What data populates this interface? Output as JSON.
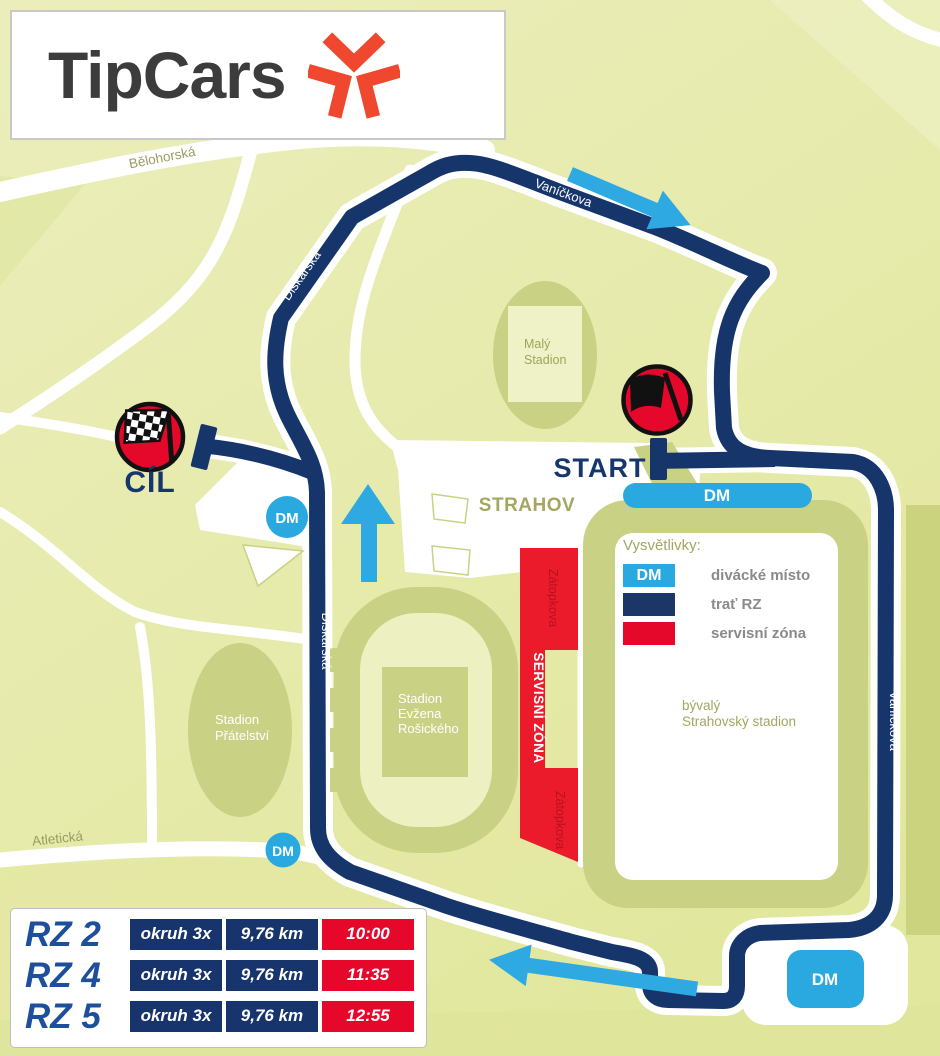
{
  "logo": {
    "brand": "TipCars"
  },
  "colors": {
    "navy": "#16356B",
    "light_blue": "#29A9E0",
    "red": "#E5082B",
    "service_red": "#EC1B2C",
    "olive": "#C9D184",
    "brand_red": "#F0482F"
  },
  "map": {
    "streets": {
      "belohorska": "Bělohorská",
      "vanickova": "Vaníčkova",
      "diskarska": "Diskařská",
      "atleticka": "Atletická",
      "zatopkova": "Zátopkova"
    },
    "labels": {
      "strahov": "STRAHOV",
      "service_zone": "SERVISNÍ ZÓNA",
      "maly_stadion": [
        "Malý",
        "Stadion"
      ],
      "stadion_pratelstvi": [
        "Stadion",
        "Přátelství"
      ],
      "stadion_rosickeho": [
        "Stadion",
        "Evžena",
        "Rošického"
      ],
      "byvaly_stadion": [
        "bývalý",
        "Strahovský stadion"
      ]
    },
    "markers": {
      "start": "START",
      "finish": "CÍL",
      "spectator": "DM"
    }
  },
  "legend": {
    "title": "Vysvětlivky:",
    "items": [
      {
        "swatch_label": "DM",
        "label": "divácké místo"
      },
      {
        "swatch_label": "",
        "label": "trať RZ"
      },
      {
        "swatch_label": "",
        "label": "servisní zóna"
      }
    ]
  },
  "schedule": {
    "rows": [
      {
        "stage": "RZ 2",
        "laps": "okruh 3x",
        "distance": "9,76 km",
        "time": "10:00"
      },
      {
        "stage": "RZ 4",
        "laps": "okruh 3x",
        "distance": "9,76 km",
        "time": "11:35"
      },
      {
        "stage": "RZ 5",
        "laps": "okruh 3x",
        "distance": "9,76 km",
        "time": "12:55"
      }
    ]
  }
}
